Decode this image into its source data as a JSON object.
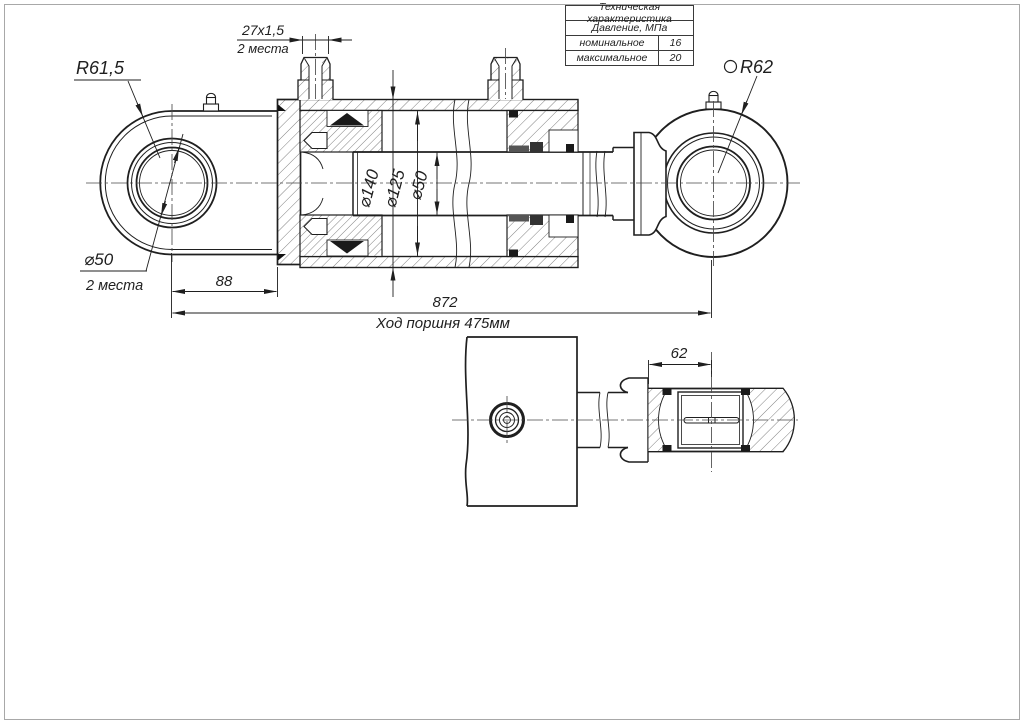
{
  "table": {
    "header": "Техническая характеристика",
    "subheader": "Давление, МПа",
    "rows": [
      {
        "label": "номинальное",
        "value": "16"
      },
      {
        "label": "максимальное",
        "value": "20"
      }
    ]
  },
  "dims": {
    "left_eye_radius": "R61,5",
    "right_eye_radius": "R62",
    "thread": "27x1,5",
    "thread_places": "2 места",
    "eye_bore": "⌀50",
    "eye_bore_places": "2 места",
    "cylinder_od": "⌀140",
    "cylinder_bore": "⌀125",
    "rod_diameter": "⌀50",
    "cap_to_eye_center": "88",
    "center_to_center": "872",
    "stroke_note": "Ход поршня 475мм",
    "eye_hub_width": "62"
  },
  "colors": {
    "line": "#1f1f1f",
    "background": "#ffffff",
    "page_border": "#a8a8a8"
  }
}
